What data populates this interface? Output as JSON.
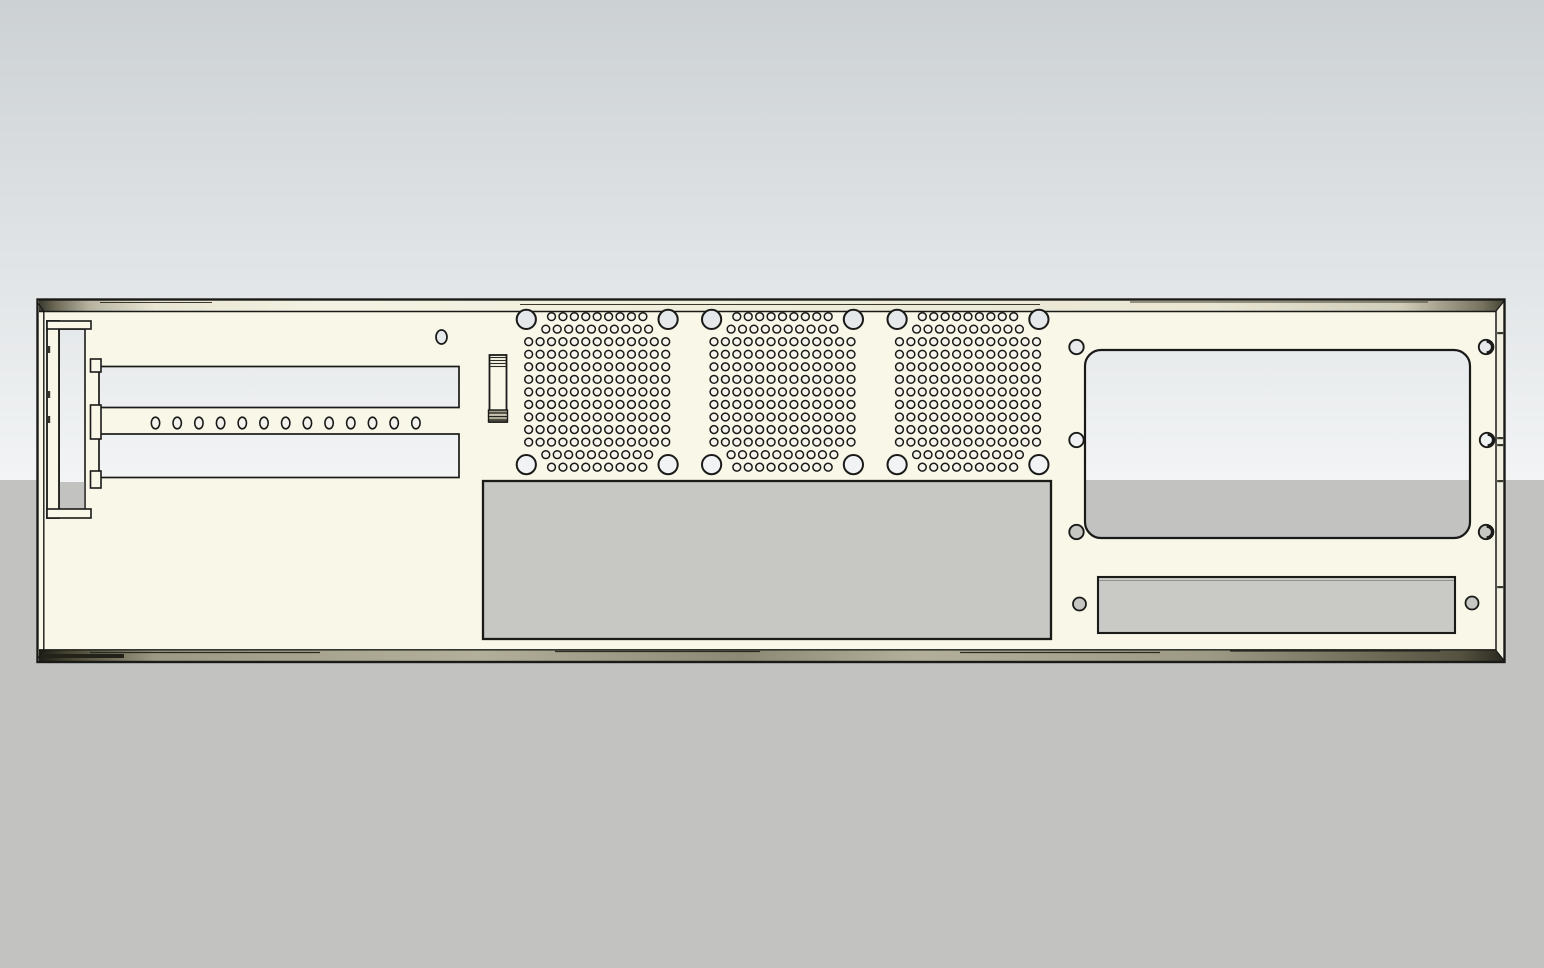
{
  "canvas": {
    "width": 1544,
    "height": 968
  },
  "colors": {
    "sky_top": "#ccd1d4",
    "sky_bottom": "#f2f4f5",
    "ground": "#c2c3c0",
    "panel_cream": "#f9f7e8",
    "panel_side_face": "#f2f0e0",
    "outline_dark": "#1a1a18",
    "streak_dark": "#3a392c",
    "vent_hole_fill": "#f6f4ec",
    "strip_hole_fill": "#f3f2ec",
    "psu_gray": "#c7c8c4",
    "aux_gray": "#c9cac5",
    "below_horizon_hole": "#c6c7c3",
    "top_band_stops": [
      [
        0,
        "#35342a"
      ],
      [
        0.012,
        "#6b6856"
      ],
      [
        0.035,
        "#b5b2a0"
      ],
      [
        0.08,
        "#e8e5d4"
      ],
      [
        0.2,
        "#f4f2e2"
      ],
      [
        0.5,
        "#efeddb"
      ],
      [
        0.8,
        "#e9e6d4"
      ],
      [
        0.93,
        "#cfccba"
      ],
      [
        0.985,
        "#76735f"
      ],
      [
        1,
        "#454335"
      ]
    ],
    "bottom_band_stops": [
      [
        0,
        "#1c1b15"
      ],
      [
        0.02,
        "#44422f"
      ],
      [
        0.08,
        "#9c9984"
      ],
      [
        0.3,
        "#b2af9a"
      ],
      [
        0.48,
        "#8b8874"
      ],
      [
        0.6,
        "#b2af9a"
      ],
      [
        0.8,
        "#9c9984"
      ],
      [
        0.97,
        "#55523f"
      ],
      [
        1,
        "#2a2920"
      ]
    ]
  },
  "background": {
    "horizon_y": 480
  },
  "panel": {
    "outer": {
      "x": 37.5,
      "y": 299.5,
      "w": 1467,
      "h": 362.5
    },
    "top_flange": {
      "x": 39,
      "y": 300.5,
      "w": 1464.5,
      "h": 11,
      "bottom_line_y": 311.5
    },
    "bottom_flange": {
      "x": 39,
      "y": 650,
      "w": 1464.5,
      "h": 11.5,
      "top_line_y": 649.8
    },
    "left_inner_edge_x": 43.8,
    "right_inner_edge_x": 1496,
    "edge_top_y": 311,
    "edge_bottom_y": 650.5,
    "top_streaks": [
      {
        "x1": 100,
        "x2": 212,
        "y": 302.5
      },
      {
        "x1": 520,
        "x2": 1040,
        "y": 304.5
      },
      {
        "x1": 1130,
        "x2": 1428,
        "y": 302
      }
    ],
    "bottom_streaks": [
      {
        "x1": 90,
        "x2": 320,
        "y": 652.5
      },
      {
        "x1": 555,
        "x2": 760,
        "y": 651.5
      },
      {
        "x1": 960,
        "x2": 1160,
        "y": 652.5
      },
      {
        "x1": 1230,
        "x2": 1440,
        "y": 651
      }
    ],
    "right_edge_ticks_y": [
      332,
      437,
      444,
      480,
      586
    ],
    "corner_blob": {
      "x": 44,
      "y": 654,
      "w": 80,
      "h": 4
    }
  },
  "bracket": {
    "bar": {
      "x": 47,
      "y": 321,
      "w": 12,
      "h": 197
    },
    "top_cap": {
      "x": 47,
      "y": 321,
      "w": 44,
      "h": 8
    },
    "bottom_cap": {
      "x": 47,
      "y": 509,
      "w": 44,
      "h": 9
    },
    "opening": {
      "x": 59,
      "y": 329,
      "w": 26,
      "h": 181
    },
    "tabs": {
      "x": 90.5,
      "w": 10.5,
      "rows": [
        {
          "y": 359,
          "h": 13
        },
        {
          "y": 405,
          "h": 34
        },
        {
          "y": 471,
          "h": 17
        }
      ]
    },
    "bar_ticks_y": [
      346,
      391,
      416
    ]
  },
  "slot_cutouts": [
    {
      "x": 99,
      "y": 366.5,
      "w": 360,
      "h": 41
    },
    {
      "x": 99,
      "y": 434,
      "w": 360,
      "h": 43.5
    }
  ],
  "screw_strip_holes": {
    "y": 423,
    "start_x": 155.5,
    "pitch": 21.7,
    "count": 13,
    "rx": 4.2,
    "ry": 5.8
  },
  "pilot_hole": {
    "cx": 441.5,
    "cy": 337,
    "rx": 5.5,
    "ry": 7
  },
  "latch": {
    "body": {
      "x": 489.5,
      "y": 355,
      "w": 17,
      "h": 67
    },
    "cap_lines_y": [
      357.5,
      360.5,
      363.5,
      366.5
    ],
    "foot": {
      "y": 410,
      "h": 12
    },
    "foot_lines_y": [
      413,
      416.5,
      420
    ]
  },
  "fan_grilles": {
    "centers_x": [
      597.2,
      782.5,
      968
    ],
    "center_y": 392,
    "field_top_y": 316.6,
    "pitch_x": 11.42,
    "pitch_y": 12.55,
    "row_counts": [
      9,
      10,
      13,
      13,
      13,
      13,
      13,
      13,
      13,
      13,
      13,
      10,
      9
    ],
    "hole_radius": 3.9,
    "corner_dx": 70.9,
    "corner_dy": 72.6,
    "corner_radius": 9.6
  },
  "psu_cutout": {
    "x": 483,
    "y": 481,
    "w": 568,
    "h": 158
  },
  "io_cutout": {
    "x": 1085,
    "y": 350,
    "w": 385,
    "h": 188,
    "rx": 16
  },
  "io_screw_holes": [
    {
      "cx": 1076.5,
      "cy": 347,
      "crescent": false
    },
    {
      "cx": 1076.5,
      "cy": 440,
      "crescent": false
    },
    {
      "cx": 1076.5,
      "cy": 532,
      "crescent": false
    },
    {
      "cx": 1486,
      "cy": 347,
      "crescent": true
    },
    {
      "cx": 1487,
      "cy": 440,
      "crescent": true
    },
    {
      "cx": 1486,
      "cy": 532,
      "crescent": true
    }
  ],
  "io_screw_radius": 7.2,
  "aux_cutout": {
    "x": 1098,
    "y": 577,
    "w": 357,
    "h": 56,
    "inner_line_y": 580.5
  },
  "aux_screw_holes": [
    {
      "cx": 1079.5,
      "cy": 604
    },
    {
      "cx": 1472,
      "cy": 603
    }
  ],
  "aux_screw_radius": 6.5
}
